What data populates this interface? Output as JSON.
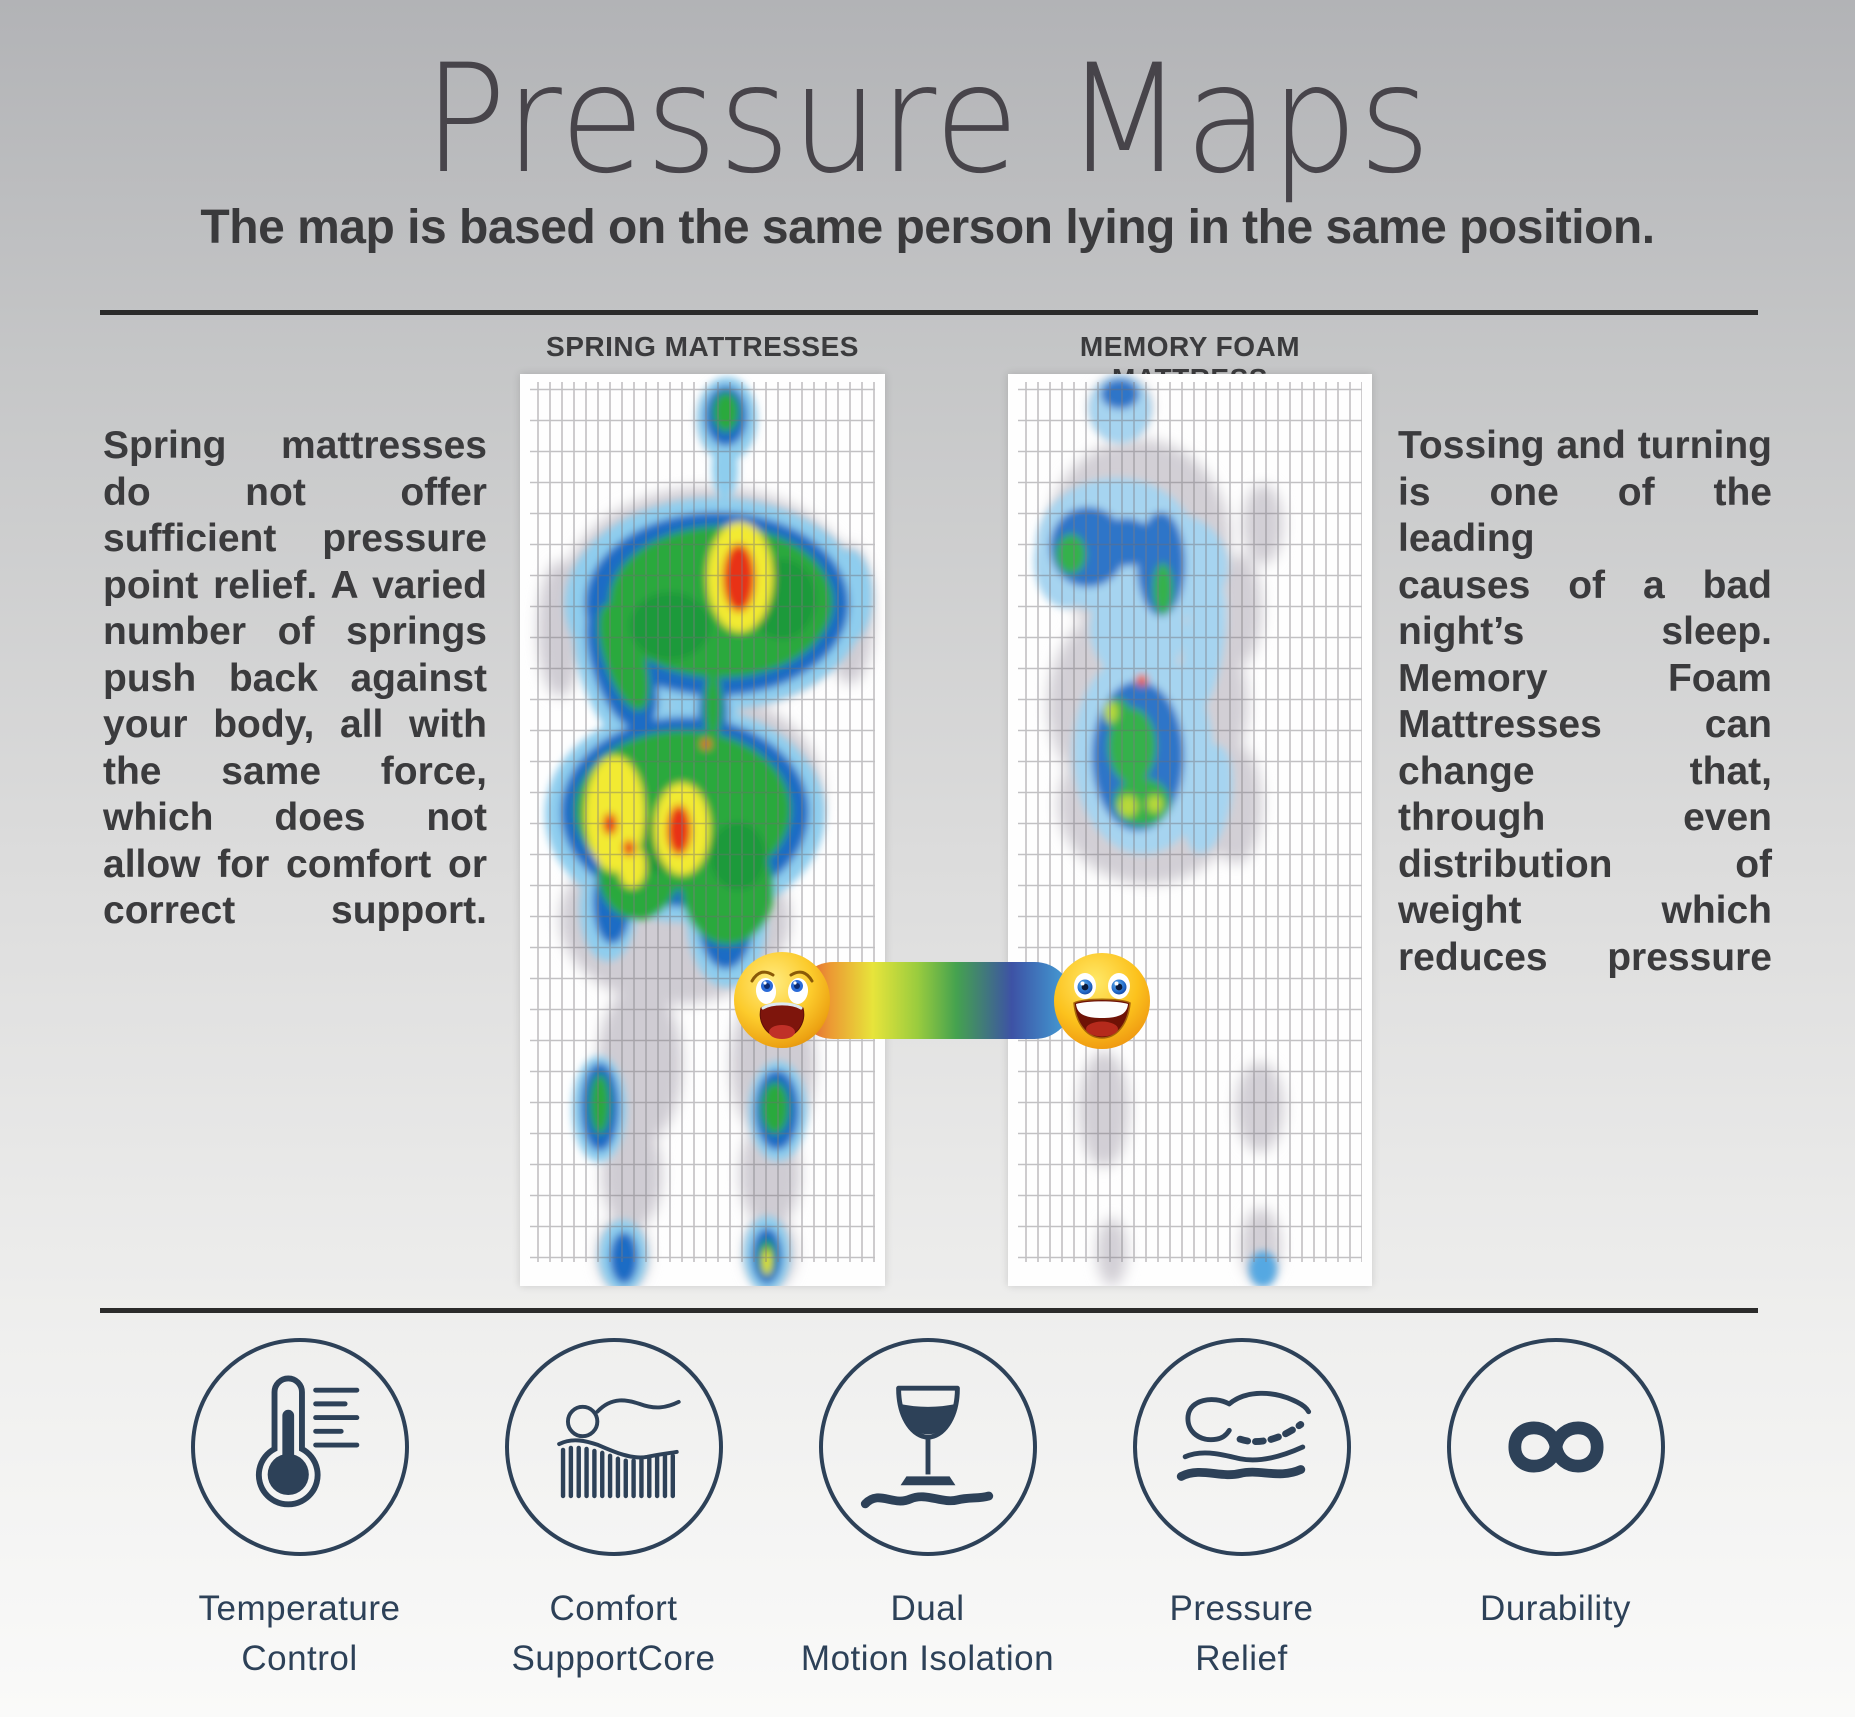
{
  "page": {
    "title": "Pressure Maps",
    "subtitle": "The map is based on the same person lying in the same position."
  },
  "maps": {
    "spring": {
      "header": "SPRING MATTRESSES",
      "paragraph_lines": [
        "Spring mattresses",
        "do not offer",
        "sufficient pressure",
        "point relief. A varied",
        "number of springs",
        "push back against",
        "your body, all with",
        "the same force,",
        "which does not",
        "allow for comfort or",
        "correct support."
      ]
    },
    "memory": {
      "header": "MEMORY FOAM MATTRESS",
      "paragraph_lines": [
        "Tossing and turning",
        "is one of the leading",
        "causes of a bad",
        "night’s sleep.",
        "Memory Foam",
        "Mattresses can",
        "change that,",
        "through even",
        "distribution of",
        "weight which",
        "reduces pressure"
      ]
    }
  },
  "scale": {
    "bad_emoji": "anguished-face",
    "good_emoji": "grinning-face",
    "gradient_stops": [
      "#dc4a34 0%",
      "#ec9b33 13%",
      "#e7e43b 28%",
      "#9acc3e 44%",
      "#45a24f 58%",
      "#3d52a5 78%",
      "#4187c6 92%",
      "#49a3d9 100%"
    ],
    "map_palette": {
      "body_outline": "#cfccd3",
      "very_low": "#8ecdee",
      "low": "#1f6cc5",
      "medium": "#2aa93e",
      "high": "#f2ea33",
      "very_high": "#e83018"
    }
  },
  "features": [
    {
      "icon": "thermometer-icon",
      "label": "Temperature\nControl"
    },
    {
      "icon": "spring-support-icon",
      "label": "Comfort\nSupportCore"
    },
    {
      "icon": "wine-glass-icon",
      "label": "Dual\nMotion Isolation"
    },
    {
      "icon": "pressure-contour-icon",
      "label": "Pressure\nRelief"
    },
    {
      "icon": "infinity-icon",
      "label": "Durability"
    }
  ],
  "colors": {
    "accent_navy": "#2d4158",
    "text_dark": "#3b3b3d",
    "rule": "#2b2b2b"
  }
}
